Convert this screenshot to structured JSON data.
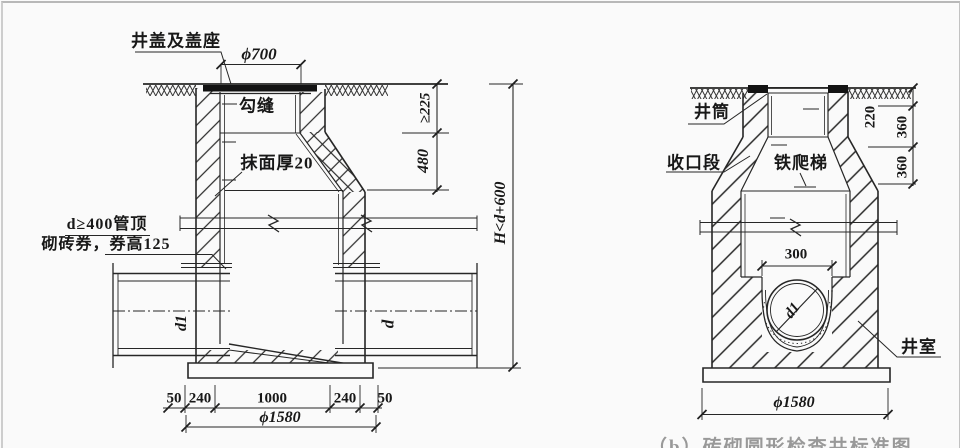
{
  "left": {
    "cover_seat": "井盖及盖座",
    "joint": "勾缝",
    "plaster": "抹面厚20",
    "arch_note1": "d≥400管顶",
    "arch_note2": "砌砖券，券高125",
    "dia_top": "ϕ700",
    "depth_min": "≥225",
    "cone_h": "480",
    "total_h": "H<d+600",
    "seg": [
      "50",
      "240",
      "1000",
      "240",
      "50"
    ],
    "dia_bottom": "ϕ1580",
    "pipe_left": "d1",
    "pipe_right": "d"
  },
  "right": {
    "shaft": "井筒",
    "taper": "收口段",
    "ladder": "铁爬梯",
    "chamber": "井室",
    "h_shaft": "220",
    "h_course_a": "360",
    "h_course_b": "360",
    "w_channel": "300",
    "pipe": "d1",
    "dia_bottom": "ϕ1580"
  },
  "caption_fragment": "（b）砖砌圆形检查井标准图"
}
